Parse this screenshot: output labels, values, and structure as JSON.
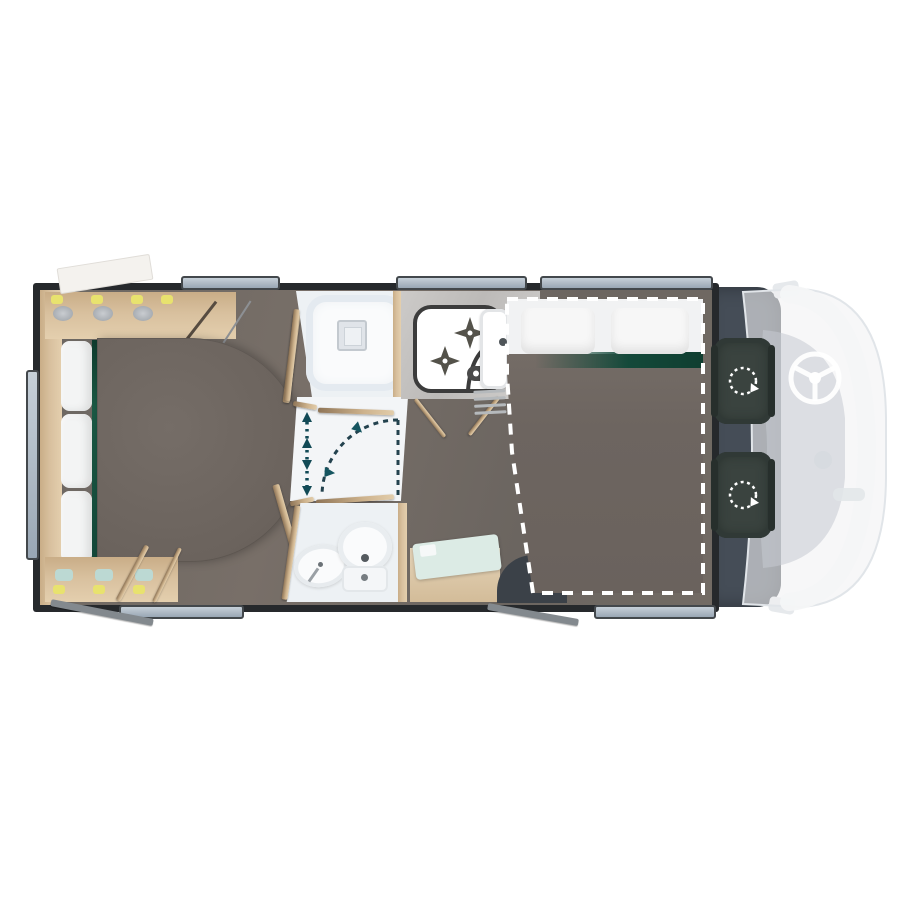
{
  "scene": {
    "name": "motorhome-floor-plan",
    "view": "top-down",
    "cab_side": "right"
  },
  "colors": {
    "background": "#ffffff",
    "wall": "#26292c",
    "floor": "#6f6a64",
    "wood": "#d8c09e",
    "wood_shadow": "#a98c66",
    "cushion": "#f3f4f4",
    "green_accent": "#14493a",
    "table": "#6f6862",
    "bathroom_floor": "#edf1f4",
    "fixture_white": "#fafbfc",
    "counter": "#c9c7c5",
    "appliance_outline": "#3c3c3c",
    "window_fill": "#aeb9c4",
    "window_frame": "#43484c",
    "cab": "#454d57",
    "seat": "#3a433f",
    "ghost_body": "#eef0f2",
    "dashboard": "#c6cbd1",
    "arrow_teal": "#124a56",
    "arrow_navy": "#23424e",
    "mint_board": "#dcebe5",
    "entry_mat": "#3b4148",
    "flap_gray": "#83898e",
    "blanket": "#6f6862",
    "pillow": "#f7f7f7",
    "sheet": "#f1f2f3",
    "bed_outline": "#ffffff"
  },
  "rooms": [
    {
      "name": "rear-lounge",
      "fixtures": [
        "overhead-storage",
        "corner-cabinet",
        "seat-cushions",
        "dinette-table",
        "storage-cabinet",
        "open-door-battens"
      ]
    },
    {
      "name": "shower-room",
      "fixtures": [
        "shower-tray",
        "shower-drain"
      ]
    },
    {
      "name": "hallway",
      "fixtures": [
        "sliding-door-tracks"
      ]
    },
    {
      "name": "washroom",
      "fixtures": [
        "wash-basin",
        "toilet"
      ]
    },
    {
      "name": "kitchen",
      "fixtures": [
        "two-burner-hob",
        "kitchen-sink",
        "open-cabinet-doors",
        "vent-grill",
        "base-cabinet",
        "cutting-board",
        "entry-mat"
      ]
    },
    {
      "name": "bedroom",
      "fixtures": [
        "double-bed",
        "pillow-left",
        "pillow-right",
        "blanket",
        "green-runner"
      ]
    },
    {
      "name": "driver-cab",
      "fixtures": [
        "swivel-seat-front",
        "swivel-seat-rear",
        "steering-wheel",
        "dashboard",
        "wing-mirror-top",
        "wing-mirror-bottom"
      ]
    }
  ],
  "annotations": [
    {
      "name": "walkway-arrow",
      "type": "dotted-double-headed-arrow"
    },
    {
      "name": "door-swing",
      "type": "dashed-quarter-arc"
    },
    {
      "name": "bed-outline",
      "type": "white-dashed-border"
    },
    {
      "name": "seat-rotation",
      "type": "dashed-circle-arrow",
      "count": 2
    }
  ],
  "windows": {
    "top": 3,
    "bottom": 2,
    "rear": 1,
    "open_flaps": 3
  }
}
